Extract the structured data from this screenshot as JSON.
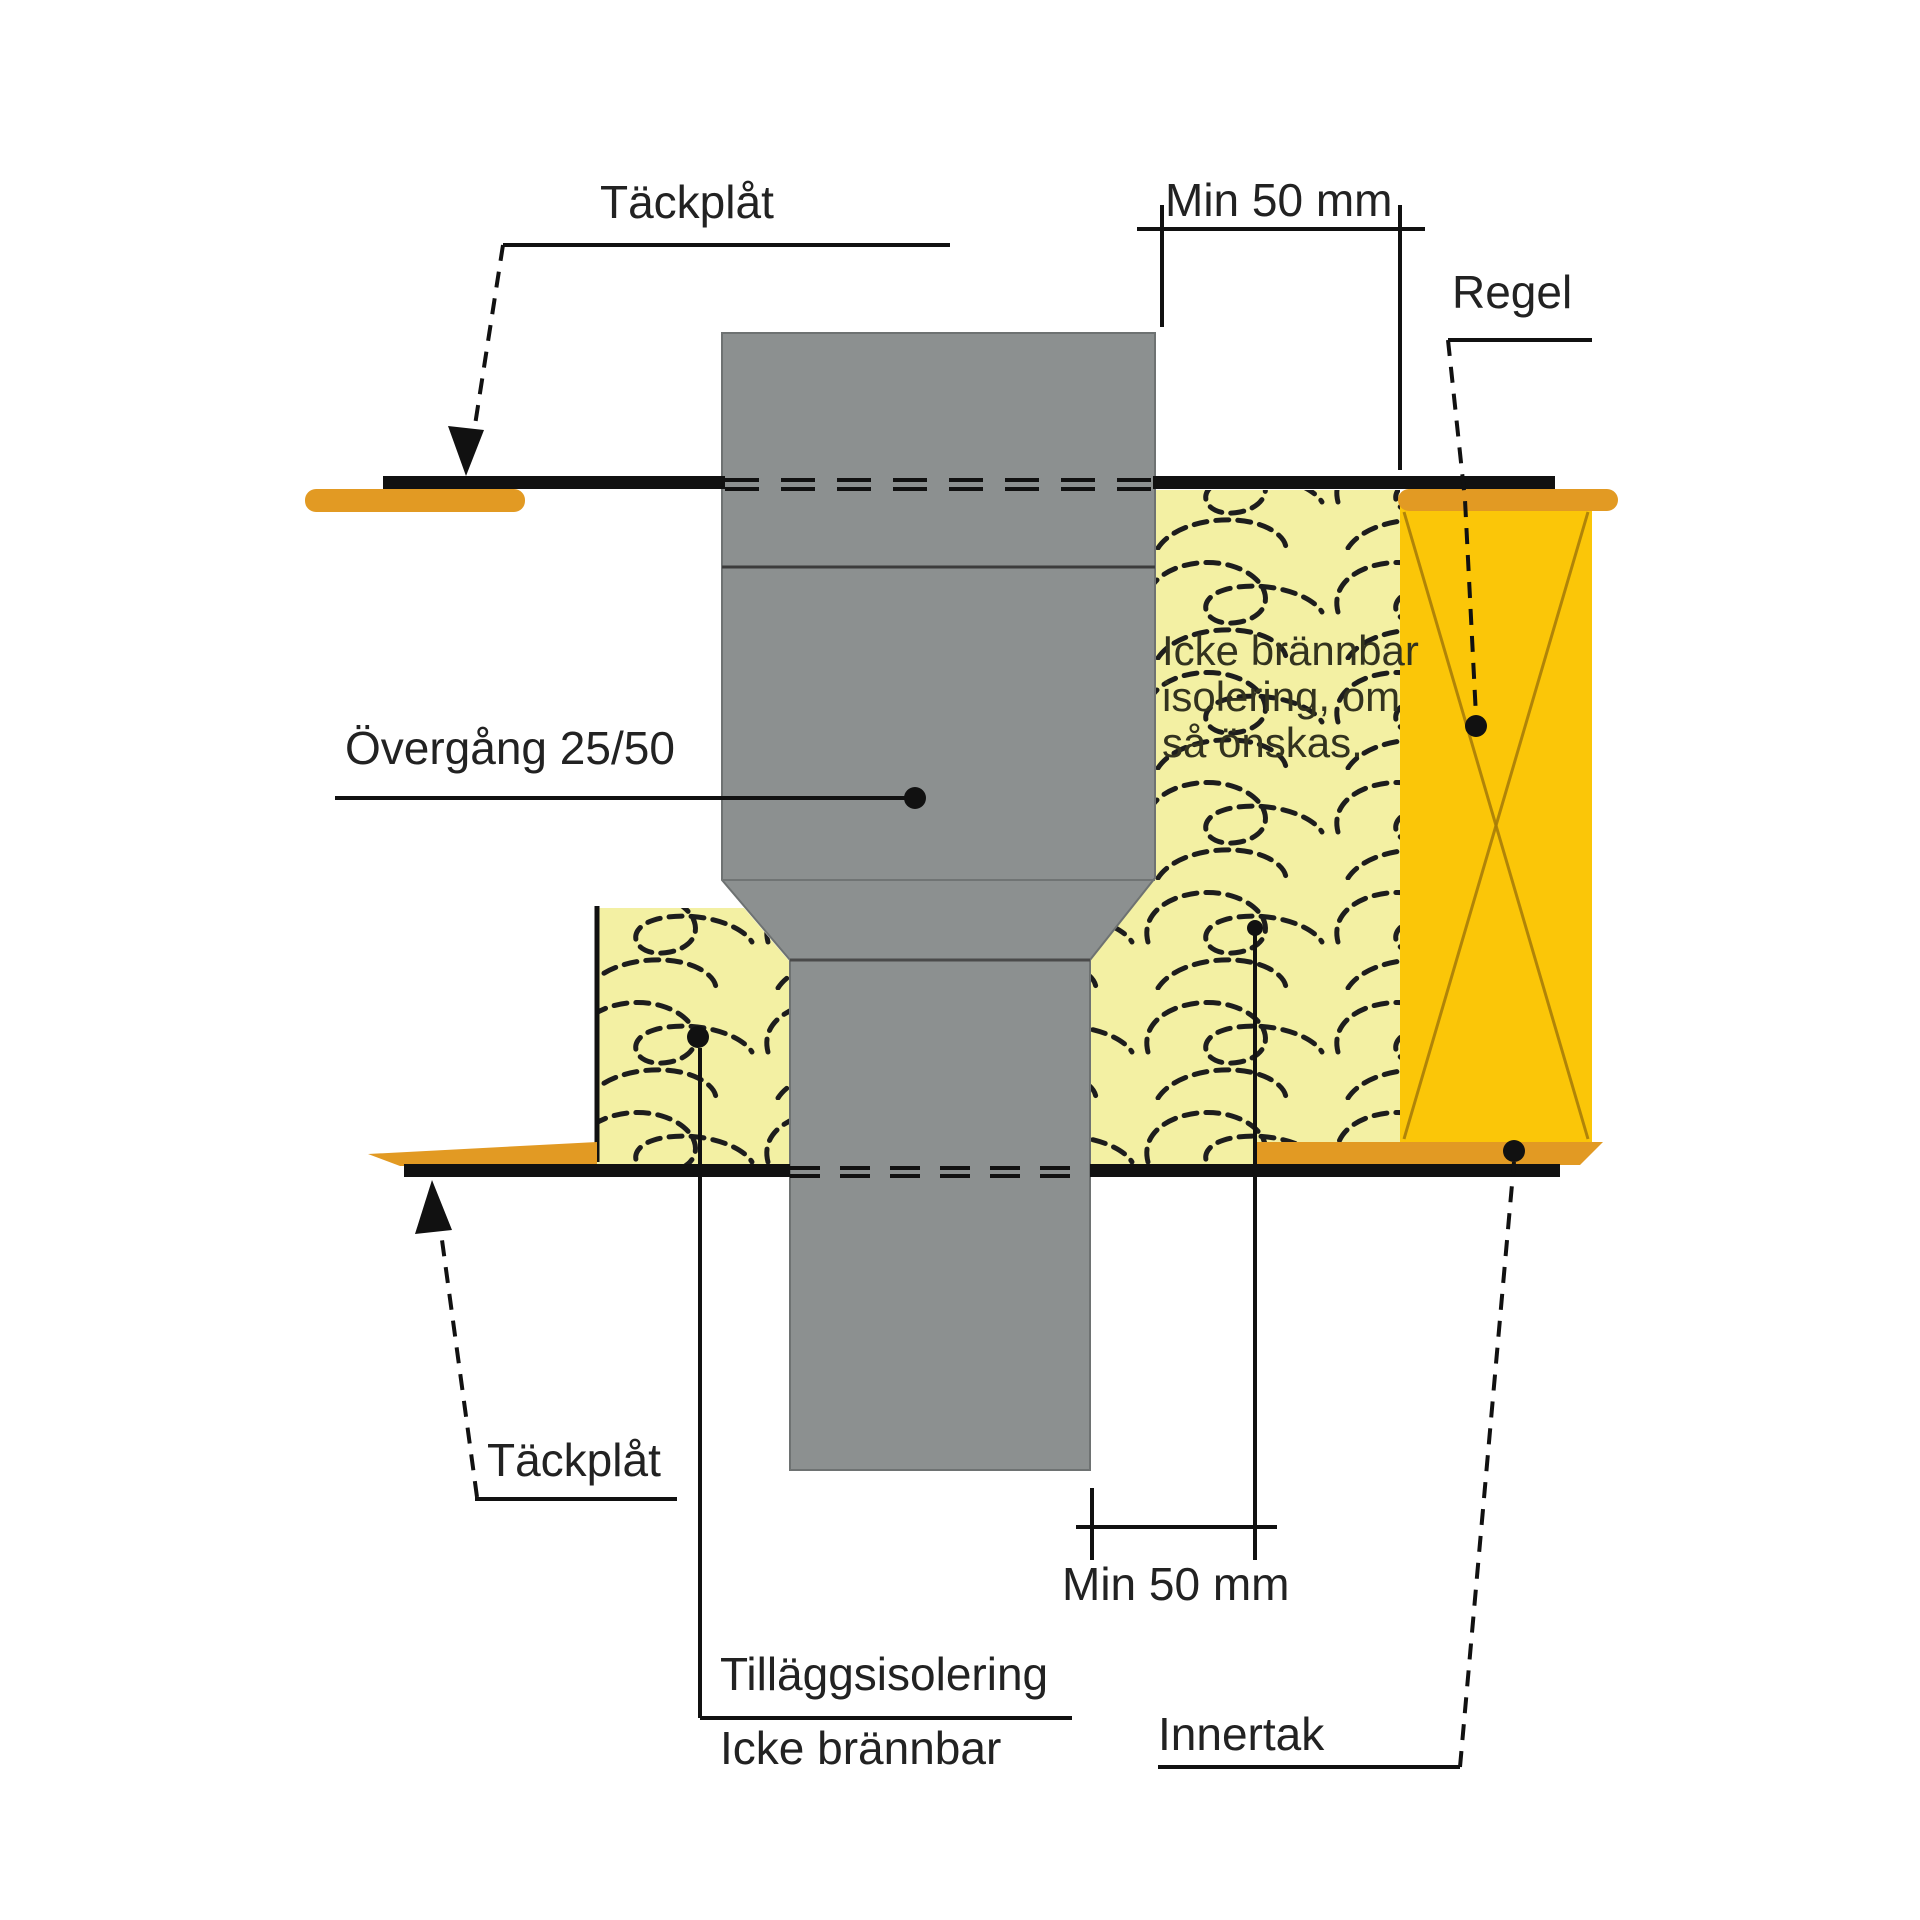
{
  "diagram_title": "Duct ceiling penetration fire-insulation detail",
  "labels": {
    "tackplat_top": "Täckplåt",
    "min50_top": "Min 50 mm",
    "regel": "Regel",
    "overgang": "Övergång 25/50",
    "insulation_note_line1": "Icke brännbar",
    "insulation_note_line2": "isolering, om",
    "insulation_note_line3": "så önskas.",
    "tackplat_bottom": "Täckplåt",
    "min50_bottom": "Min 50 mm",
    "tillagg_line1": "Tilläggsisolering",
    "tillagg_line2": "Icke brännbar",
    "innertak": "Innertak"
  },
  "colors": {
    "duct_gray": "#8C9090",
    "insulation_yellow": "#F3F0A3",
    "regel_gold": "#FBC608",
    "regel_cross": "#A87D0A",
    "cover_plate_orange": "#E29A23",
    "line_black": "#111111",
    "text": "#222222"
  }
}
